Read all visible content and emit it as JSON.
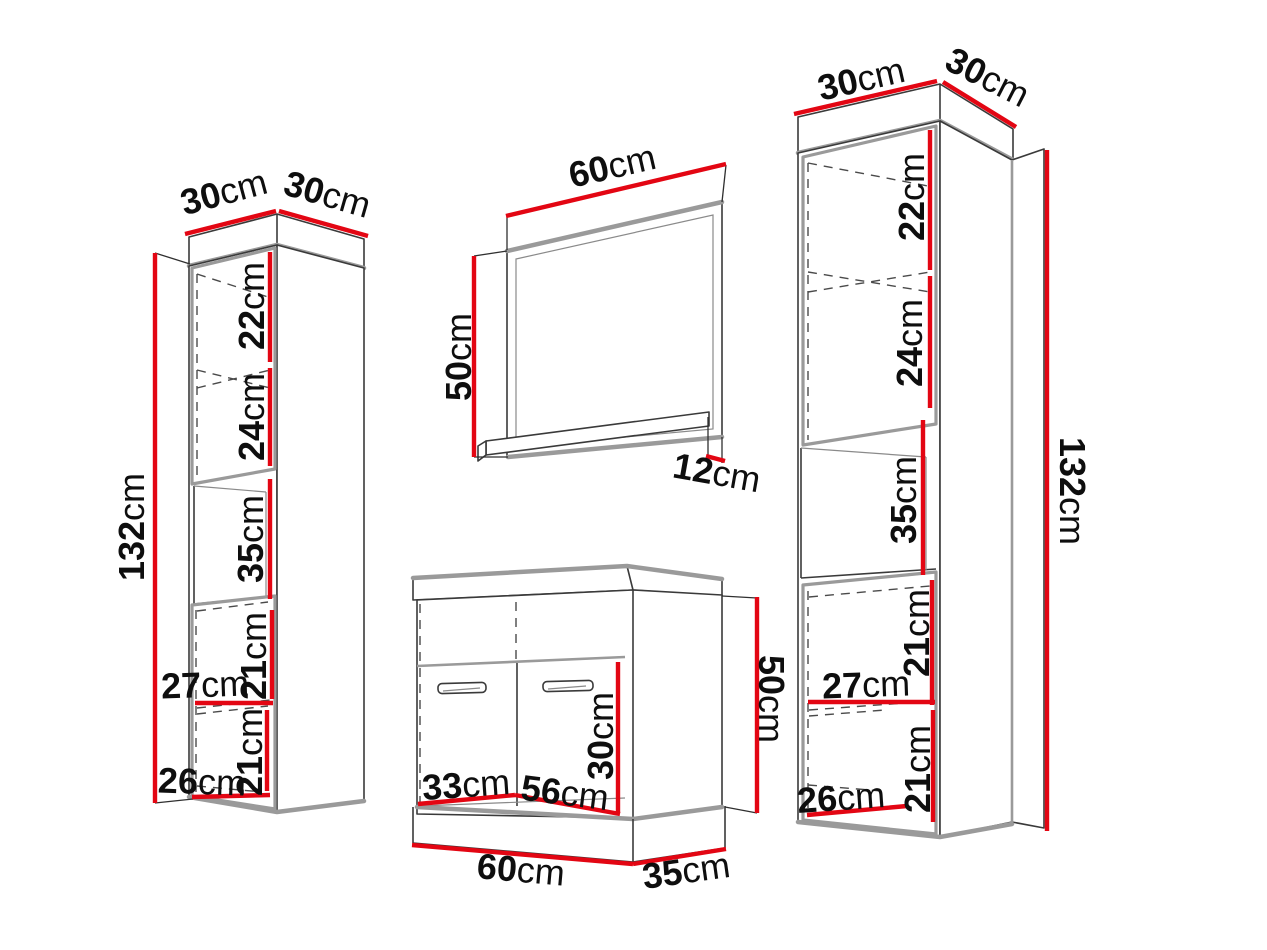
{
  "diagram_title": "bathroom furniture set dimension diagram",
  "unit": "cm",
  "colors": {
    "dimension_red": "#e30613",
    "edge_gray": "#9a9a9a",
    "outline_dark": "#3a3a3a",
    "background": "#ffffff"
  },
  "left_cabinet": {
    "name": "left tall wall cabinet",
    "top_depth": "30",
    "top_width": "30",
    "height": "132",
    "upper_shelf_space": "22",
    "lower_shelf_space": "24",
    "open_niche_height": "35",
    "bottom_upper_space": "21",
    "inner_width_upper": "27",
    "bottom_lower_space": "21",
    "inner_width_lower": "26"
  },
  "mirror": {
    "name": "mirror with shelf",
    "width": "60",
    "height": "50",
    "shelf_depth": "12"
  },
  "sink_cabinet": {
    "name": "washbasin cabinet",
    "door_height": "30",
    "inner_depth": "33",
    "inner_width": "56",
    "width": "60",
    "depth": "35",
    "height": "50"
  },
  "right_cabinet": {
    "name": "right tall wall cabinet",
    "top_depth": "30",
    "top_width": "30",
    "height": "132",
    "upper_shelf_space": "22",
    "lower_shelf_space": "24",
    "open_niche_height": "35",
    "bottom_upper_space": "21",
    "inner_width_upper": "27",
    "bottom_lower_space": "21",
    "inner_width_lower": "26"
  }
}
